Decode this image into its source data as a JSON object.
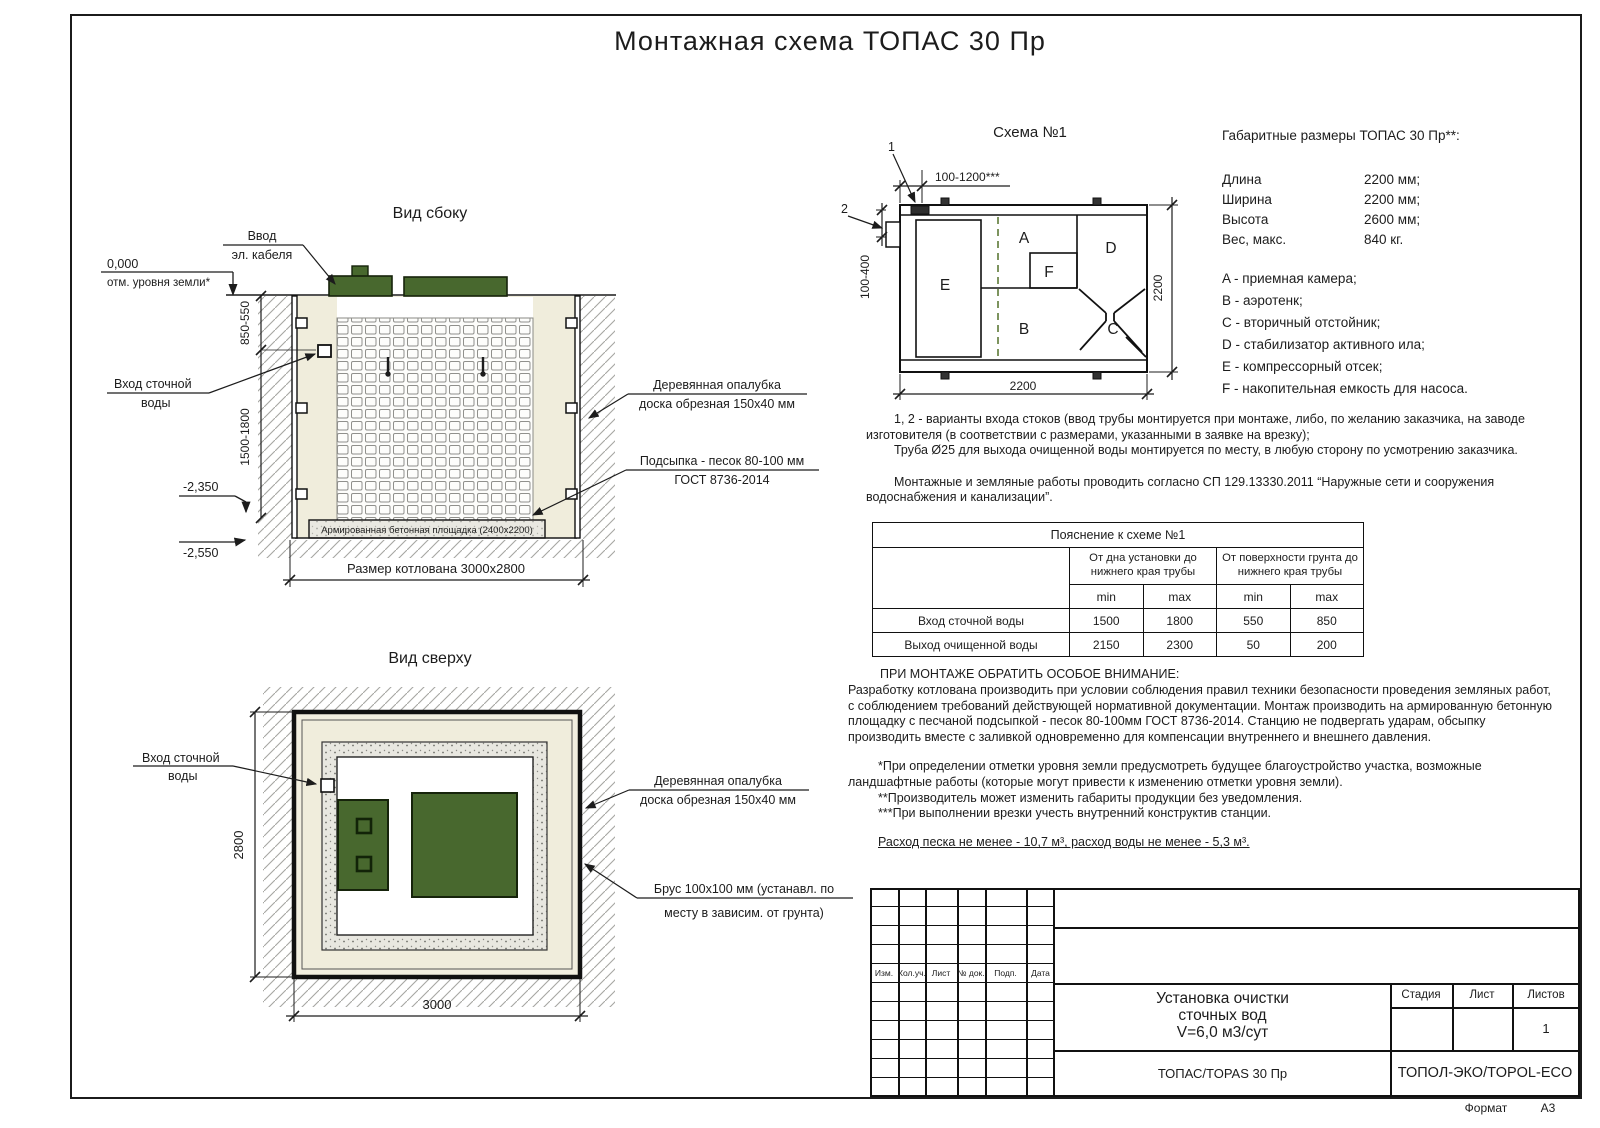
{
  "page": {
    "title": "Монтажная схема ТОПАС 30 Пр",
    "format_label": "Формат",
    "format_value": "А3"
  },
  "colors": {
    "lid_green": "#48682e",
    "sand": "#f0eddc",
    "dashed_green": "#5d7a36",
    "line": "#1c1c1c"
  },
  "side_view": {
    "title": "Вид сбоку",
    "cable_1": "Ввод",
    "cable_2": "эл. кабеля",
    "zero_mark": "0,000",
    "ground_mark": "отм. уровня земли*",
    "dim_upper": "850-550",
    "dim_lower": "1500-1800",
    "mark_2350": "-2,350",
    "mark_2550": "-2,550",
    "inlet_1": "Вход сточной",
    "inlet_2": "воды",
    "formwork_1": "Деревянная опалубка",
    "formwork_2": "доска обрезная 150х40 мм",
    "bedding_1": "Подсыпка - песок 80-100 мм",
    "bedding_2": "ГОСТ 8736-2014",
    "slab": "Армированная бетонная площадка (2400х2200)",
    "pit_dim": "Размер котлована 3000х2800"
  },
  "top_view": {
    "title": "Вид сверху",
    "inlet_1": "Вход сточной",
    "inlet_2": "воды",
    "dim_height": "2800",
    "dim_width": "3000",
    "formwork_1": "Деревянная опалубка",
    "formwork_2": "доска обрезная 150х40 мм",
    "beam_1": "Брус 100х100 мм (устанавл. по",
    "beam_2": "месту в зависим. от грунта)"
  },
  "schema": {
    "title": "Схема №1",
    "callout_1": "1",
    "callout_2": "2",
    "dim_top": "100-1200***",
    "dim_left": "100-400",
    "dim_bottom": "2200",
    "dim_right": "2200",
    "comp_a": "A",
    "comp_b": "B",
    "comp_c": "C",
    "comp_d": "D",
    "comp_e": "E",
    "comp_f": "F"
  },
  "specs": {
    "title": "Габаритные размеры ТОПАС 30 Пр**:",
    "rows": [
      {
        "label": "Длина",
        "value": "2200 мм;"
      },
      {
        "label": "Ширина",
        "value": "2200 мм;"
      },
      {
        "label": "Высота",
        "value": "2600 мм;"
      },
      {
        "label": "Вес, макс.",
        "value": "840 кг."
      }
    ],
    "legend": [
      "A - приемная камера;",
      "B - аэротенк;",
      "C - вторичный отстойник;",
      "D - стабилизатор активного ила;",
      "E - компрессорный отсек;",
      "F - накопительная емкость для насоса."
    ]
  },
  "notes": {
    "variants": "1, 2 - варианты входа  стоков (ввод трубы монтируется при монтаже, либо, по желанию заказчика, на заводе изготовителя (в соответствии с размерами, указанными в заявке на врезку);",
    "pipe": "Труба Ø25 для выхода очищенной воды монтируется по месту, в любую сторону по усмотрению заказчика.",
    "works": "Монтажные и земляные работы проводить согласно СП 129.13330.2011 “Наружные сети и сооружения водоснабжения и канализации”."
  },
  "table": {
    "title": "Пояснение к схеме №1",
    "group1": "От дна установки до нижнего края трубы",
    "group2": "От поверхности грунта до нижнего края трубы",
    "min_label": "min",
    "max_label": "max",
    "rows": [
      {
        "name": "Вход сточной воды",
        "v1": "1500",
        "v2": "1800",
        "v3": "550",
        "v4": "850"
      },
      {
        "name": "Выход очищенной воды",
        "v1": "2150",
        "v2": "2300",
        "v3": "50",
        "v4": "200"
      }
    ]
  },
  "attention": {
    "heading": "ПРИ МОНТАЖЕ ОБРАТИТЬ ОСОБОЕ ВНИМАНИЕ:",
    "body": "Разработку котлована производить при условии соблюдения правил техники безопасности проведения земляных работ, с соблюдением требований действующей нормативной документации. Монтаж производить на армированную бетонную площадку с песчаной подсыпкой - песок 80-100мм ГОСТ 8736-2014. Станцию не подвергать ударам, обсыпку производить вместе с заливкой одновременно для компенсации внутреннего и внешнего давления.",
    "footnote1": "*При определении отметки уровня земли предусмотреть будущее благоустройство участка, возможные ландшафтные работы (которые могут привести к изменению отметки уровня земли).",
    "footnote2": "**Производитель может изменить габариты продукции без уведомления.",
    "footnote3": "***При выполнении врезки учесть внутренний конструктив станции.",
    "consumption": "Расход песка не менее - 10,7 м³, расход воды не менее - 5,3 м³."
  },
  "titleblock": {
    "columns": [
      "Изм.",
      "Кол.уч.",
      "Лист",
      "№ док.",
      "Подп.",
      "Дата"
    ],
    "doc_title_1": "Установка очистки",
    "doc_title_2": "сточных вод",
    "doc_title_3": "V=6,0 м3/сут",
    "model": "ТОПАС/TOPAS 30 Пр",
    "stage": "Стадия",
    "sheet": "Лист",
    "sheets": "Листов",
    "sheets_value": "1",
    "company": "ТОПОЛ-ЭКО/TOPOL-ECO"
  }
}
